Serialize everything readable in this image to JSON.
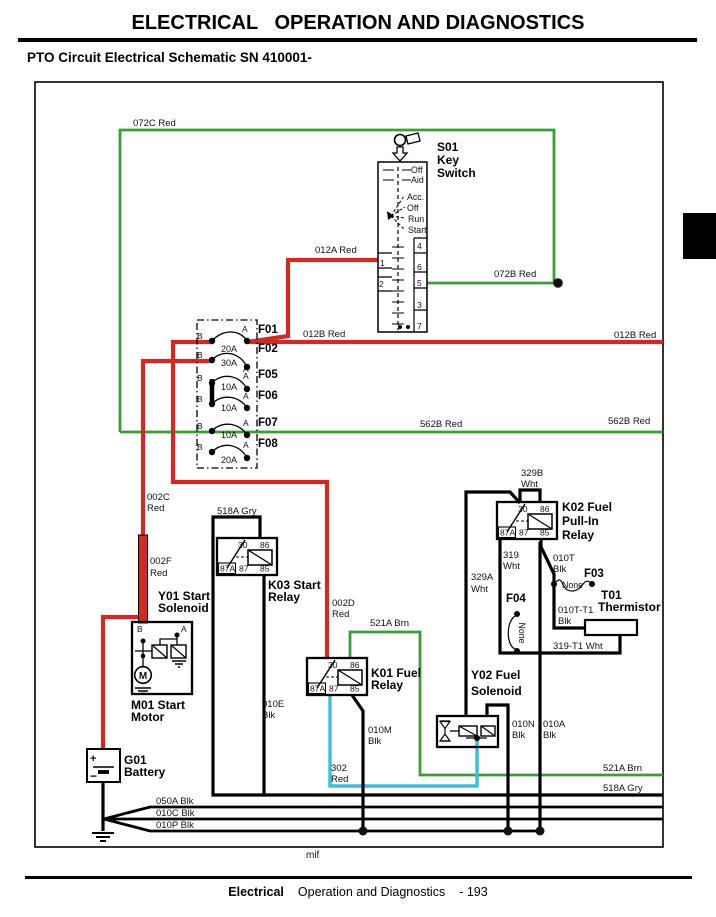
{
  "page": {
    "title": "ELECTRICAL   OPERATION AND DIAGNOSTICS",
    "subtitle": "PTO Circuit Electrical Schematic SN 410001-",
    "footer_section": "Electrical",
    "footer_rest": "Operation and Diagnostics",
    "footer_page": "- 193",
    "note": "mif"
  },
  "colors": {
    "red": "#cf2b26",
    "green": "#3d9c38",
    "cyan": "#3fbcd8",
    "black": "#000000"
  },
  "s01": {
    "ref": "S01",
    "name1": "Key",
    "name2": "Switch",
    "pos1": "Off",
    "pos2": "Aid",
    "pos3": "Acc.",
    "pos4": "Off",
    "pos5": "Run",
    "pos6": "Start",
    "t4": "4",
    "t1": "1",
    "t6": "6",
    "t2": "2",
    "t5": "5",
    "t3": "3",
    "t7": "7"
  },
  "fuse_block": {
    "b": "B",
    "a": "A",
    "fuses": [
      {
        "ref": "F01",
        "amps": "20A"
      },
      {
        "ref": "F02",
        "amps": "30A"
      },
      {
        "ref": "F05",
        "amps": "10A"
      },
      {
        "ref": "F06",
        "amps": "10A"
      },
      {
        "ref": "F07",
        "amps": "10A"
      },
      {
        "ref": "F08",
        "amps": "20A"
      }
    ]
  },
  "relay_terms": {
    "t30": "30",
    "t86": "86",
    "t87a": "87A",
    "t87": "87",
    "t85": "85"
  },
  "k03": {
    "line1": "K03 Start",
    "line2": "Relay"
  },
  "k01": {
    "line1": "K01 Fuel",
    "line2": "Relay"
  },
  "k02": {
    "line1": "K02 Fuel",
    "line2": "Pull-In",
    "line3": "Relay"
  },
  "y01": {
    "line1": "Y01 Start",
    "line2": "Solenoid",
    "b": "B",
    "a": "A",
    "m": "M"
  },
  "m01": {
    "line1": "M01 Start",
    "line2": "Motor"
  },
  "g01": {
    "line1": "G01",
    "line2": "Battery",
    "plus": "+",
    "minus": "−"
  },
  "y02": {
    "line1": "Y02 Fuel",
    "line2": "Solenoid"
  },
  "t01": {
    "ref": "T01",
    "name": "Thermistor"
  },
  "f03": {
    "ref": "F03",
    "value": "None"
  },
  "f04": {
    "ref": "F04",
    "value": "None"
  },
  "wires": {
    "w072c": "072C Red",
    "w012a": "012A Red",
    "w072b": "072B Red",
    "w012b": "012B Red",
    "w562b": "562B Red",
    "w002c_a": "002C",
    "w002c_b": "Red",
    "w518a": "518A Gry",
    "w002f_a": "002F",
    "w002f_b": "Red",
    "w002d_a": "002D",
    "w002d_b": "Red",
    "w521a": "521A Brn",
    "w329b_a": "329B",
    "w329b_b": "Wht",
    "w319_a": "319",
    "w319_b": "Wht",
    "w329a_a": "329A",
    "w329a_b": "Wht",
    "w010t_a": "010T",
    "w010t_b": "Blk",
    "w010tt1_a": "010T-T1",
    "w010tt1_b": "Blk",
    "w319t1": "319-T1 Wht",
    "w010e_a": "010E",
    "w010e_b": "Blk",
    "w010m_a": "010M",
    "w010m_b": "Blk",
    "w302_a": "302",
    "w302_b": "Red",
    "w010n_a": "010N",
    "w010n_b": "Blk",
    "w010a_a": "010A",
    "w010a_b": "Blk",
    "w050a": "050A Blk",
    "w010c": "010C Blk",
    "w010p": "010P Blk"
  }
}
